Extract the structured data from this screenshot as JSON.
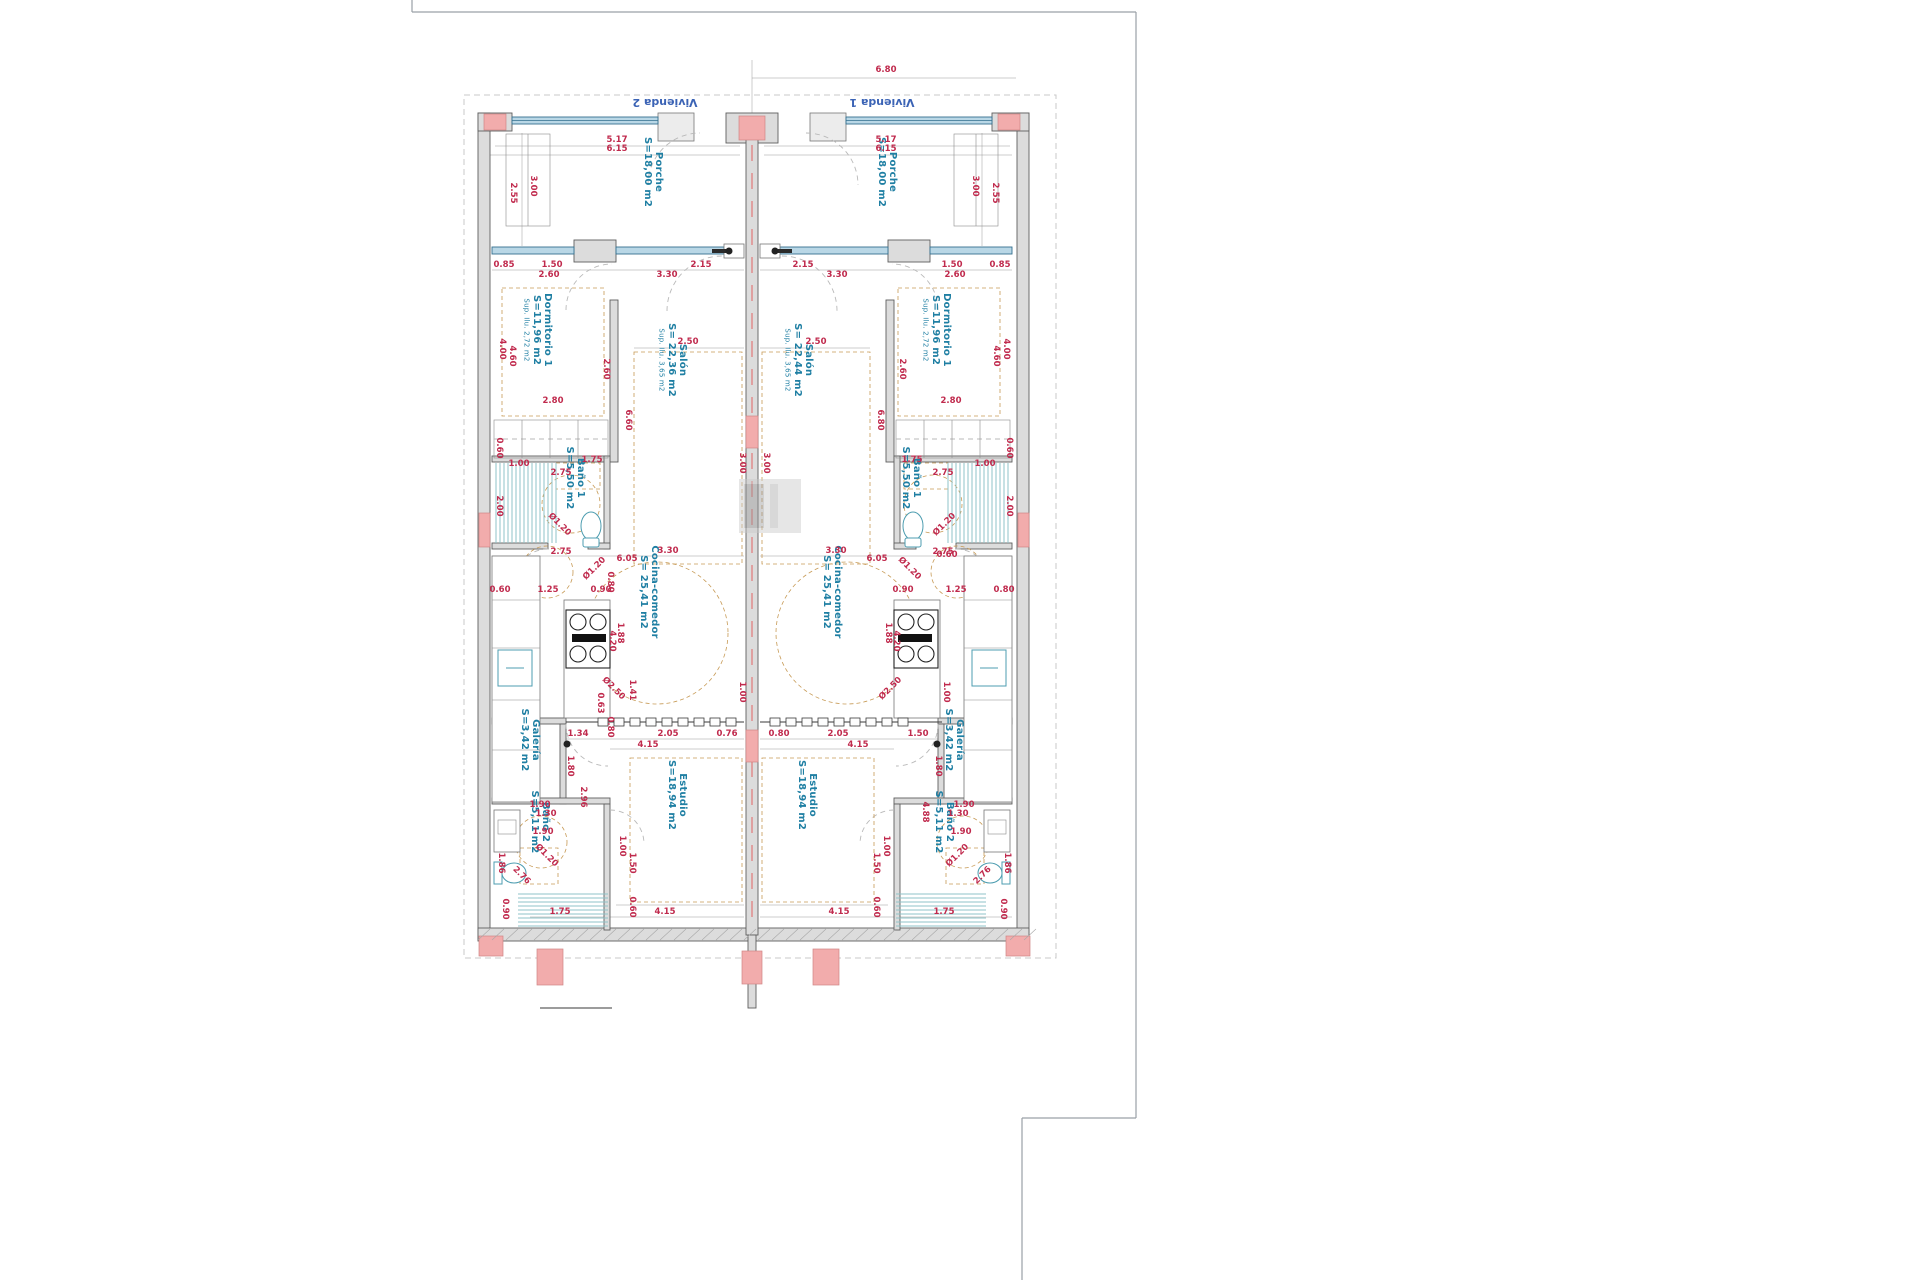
{
  "header": {
    "left_unit": "Vivienda 2",
    "right_unit": "Vivienda 1"
  },
  "rooms": {
    "porche": {
      "name": "Porche",
      "area": "S=18,00 m2"
    },
    "dormitorio1": {
      "name": "Dormitorio 1",
      "area": "S=11,96 m2",
      "sup": "Sup. Ilu. 2,72 m2"
    },
    "salon_left": {
      "name": "Salón",
      "area": "S= 22,36 m2",
      "sup": "Sup. Ilu. 3,65 m2"
    },
    "salon_right": {
      "name": "Salón",
      "area": "S= 22,44 m2",
      "sup": "Sup. Ilu. 3,65 m2"
    },
    "bano1": {
      "name": "Baño 1",
      "area": "S=5,50 m2"
    },
    "cocina": {
      "name": "Cocina-comedor",
      "area": "S= 25,41 m2"
    },
    "galeria": {
      "name": "Galería",
      "area": "S=3,42 m2"
    },
    "estudio": {
      "name": "Estudio",
      "area": "S=18,94 m2"
    },
    "bano2": {
      "name": "Baño 2",
      "area": "S=5,11 m2"
    }
  },
  "room_label_placements": [
    {
      "room": "porche",
      "x": 656,
      "y": 172
    },
    {
      "room": "porche",
      "x": 890,
      "y": 172
    },
    {
      "room": "dormitorio1",
      "x": 545,
      "y": 330
    },
    {
      "room": "dormitorio1",
      "x": 944,
      "y": 330
    },
    {
      "room": "salon_left",
      "x": 680,
      "y": 360
    },
    {
      "room": "salon_right",
      "x": 806,
      "y": 360
    },
    {
      "room": "bano1",
      "x": 578,
      "y": 478
    },
    {
      "room": "bano1",
      "x": 914,
      "y": 478
    },
    {
      "room": "cocina",
      "x": 652,
      "y": 592
    },
    {
      "room": "cocina",
      "x": 835,
      "y": 592
    },
    {
      "room": "galeria",
      "x": 533,
      "y": 740
    },
    {
      "room": "galeria",
      "x": 957,
      "y": 740
    },
    {
      "room": "estudio",
      "x": 680,
      "y": 795
    },
    {
      "room": "estudio",
      "x": 810,
      "y": 795
    },
    {
      "room": "bano2",
      "x": 543,
      "y": 822
    },
    {
      "room": "bano2",
      "x": 947,
      "y": 822
    }
  ],
  "dimensions": [
    {
      "t": "6.80",
      "x": 886,
      "y": 72
    },
    {
      "t": "5.17",
      "x": 617,
      "y": 142
    },
    {
      "t": "6.15",
      "x": 617,
      "y": 151
    },
    {
      "t": "5.17",
      "x": 886,
      "y": 142
    },
    {
      "t": "6.15",
      "x": 886,
      "y": 151
    },
    {
      "t": "3.00",
      "x": 531,
      "y": 186,
      "r": 90
    },
    {
      "t": "2.55",
      "x": 511,
      "y": 193,
      "r": 90
    },
    {
      "t": "3.00",
      "x": 973,
      "y": 186,
      "r": 90
    },
    {
      "t": "2.55",
      "x": 993,
      "y": 193,
      "r": 90
    },
    {
      "t": "0.85",
      "x": 504,
      "y": 267
    },
    {
      "t": "1.50",
      "x": 552,
      "y": 267
    },
    {
      "t": "2.60",
      "x": 549,
      "y": 277
    },
    {
      "t": "3.30",
      "x": 667,
      "y": 277
    },
    {
      "t": "2.15",
      "x": 701,
      "y": 267
    },
    {
      "t": "2.15",
      "x": 803,
      "y": 267
    },
    {
      "t": "3.30",
      "x": 837,
      "y": 277
    },
    {
      "t": "2.60",
      "x": 955,
      "y": 277
    },
    {
      "t": "1.50",
      "x": 952,
      "y": 267
    },
    {
      "t": "0.85",
      "x": 1000,
      "y": 267
    },
    {
      "t": "4.00",
      "x": 500,
      "y": 349,
      "r": 90
    },
    {
      "t": "4.60",
      "x": 510,
      "y": 356,
      "r": 90
    },
    {
      "t": "2.60",
      "x": 604,
      "y": 369,
      "r": 90
    },
    {
      "t": "2.80",
      "x": 553,
      "y": 403
    },
    {
      "t": "0.60",
      "x": 497,
      "y": 448,
      "r": 90
    },
    {
      "t": "4.00",
      "x": 1004,
      "y": 349,
      "r": 90
    },
    {
      "t": "4.60",
      "x": 994,
      "y": 356,
      "r": 90
    },
    {
      "t": "2.60",
      "x": 900,
      "y": 369,
      "r": 90
    },
    {
      "t": "2.80",
      "x": 951,
      "y": 403
    },
    {
      "t": "0.60",
      "x": 1007,
      "y": 448,
      "r": 90
    },
    {
      "t": "2.50",
      "x": 688,
      "y": 344
    },
    {
      "t": "3.00",
      "x": 740,
      "y": 463,
      "r": 90
    },
    {
      "t": "6.60",
      "x": 626,
      "y": 420,
      "r": 90
    },
    {
      "t": "2.50",
      "x": 816,
      "y": 344
    },
    {
      "t": "3.00",
      "x": 764,
      "y": 463,
      "r": 90
    },
    {
      "t": "6.80",
      "x": 878,
      "y": 420,
      "r": 90
    },
    {
      "t": "1.00",
      "x": 519,
      "y": 466
    },
    {
      "t": "2.75",
      "x": 561,
      "y": 475
    },
    {
      "t": "1.75",
      "x": 592,
      "y": 462
    },
    {
      "t": "2.00",
      "x": 497,
      "y": 506,
      "r": 90
    },
    {
      "t": "Ø1.20",
      "x": 558,
      "y": 526,
      "r": 45
    },
    {
      "t": "1.75",
      "x": 912,
      "y": 462
    },
    {
      "t": "2.75",
      "x": 943,
      "y": 475
    },
    {
      "t": "1.00",
      "x": 985,
      "y": 466
    },
    {
      "t": "2.00",
      "x": 1007,
      "y": 506,
      "r": 90
    },
    {
      "t": "Ø1.20",
      "x": 946,
      "y": 526,
      "r": -45
    },
    {
      "t": "2.75",
      "x": 561,
      "y": 554
    },
    {
      "t": "6.05",
      "x": 627,
      "y": 561
    },
    {
      "t": "3.30",
      "x": 668,
      "y": 553
    },
    {
      "t": "0.80",
      "x": 608,
      "y": 582,
      "r": 90
    },
    {
      "t": "Ø1.20",
      "x": 596,
      "y": 570,
      "r": -45
    },
    {
      "t": "0.60",
      "x": 500,
      "y": 592
    },
    {
      "t": "1.25",
      "x": 548,
      "y": 592
    },
    {
      "t": "0.90",
      "x": 601,
      "y": 592
    },
    {
      "t": "1.88",
      "x": 618,
      "y": 633,
      "r": 90
    },
    {
      "t": "4.20",
      "x": 610,
      "y": 641,
      "r": 90
    },
    {
      "t": "Ø2.50",
      "x": 612,
      "y": 690,
      "r": 45
    },
    {
      "t": "1.41",
      "x": 630,
      "y": 690,
      "r": 90
    },
    {
      "t": "0.63",
      "x": 598,
      "y": 703,
      "r": 90
    },
    {
      "t": "1.00",
      "x": 740,
      "y": 692,
      "r": 90
    },
    {
      "t": "0.80",
      "x": 608,
      "y": 727,
      "r": 90
    },
    {
      "t": "2.75",
      "x": 943,
      "y": 554
    },
    {
      "t": "6.05",
      "x": 877,
      "y": 561
    },
    {
      "t": "3.30",
      "x": 836,
      "y": 553
    },
    {
      "t": "0.60",
      "x": 947,
      "y": 557
    },
    {
      "t": "Ø1.20",
      "x": 908,
      "y": 570,
      "r": 45
    },
    {
      "t": "0.90",
      "x": 903,
      "y": 592
    },
    {
      "t": "1.25",
      "x": 956,
      "y": 592
    },
    {
      "t": "0.80",
      "x": 1004,
      "y": 592
    },
    {
      "t": "1.88",
      "x": 886,
      "y": 633,
      "r": 90
    },
    {
      "t": "4.20",
      "x": 894,
      "y": 641,
      "r": 90
    },
    {
      "t": "Ø2.50",
      "x": 892,
      "y": 690,
      "r": -45
    },
    {
      "t": "1.00",
      "x": 944,
      "y": 692,
      "r": 90
    },
    {
      "t": "1.34",
      "x": 578,
      "y": 736
    },
    {
      "t": "2.05",
      "x": 668,
      "y": 736
    },
    {
      "t": "0.76",
      "x": 727,
      "y": 736
    },
    {
      "t": "4.15",
      "x": 648,
      "y": 747
    },
    {
      "t": "0.80",
      "x": 779,
      "y": 736
    },
    {
      "t": "2.05",
      "x": 838,
      "y": 736
    },
    {
      "t": "1.50",
      "x": 918,
      "y": 736
    },
    {
      "t": "4.15",
      "x": 858,
      "y": 747
    },
    {
      "t": "1.80",
      "x": 568,
      "y": 766,
      "r": 90
    },
    {
      "t": "2.96",
      "x": 581,
      "y": 797,
      "r": 90
    },
    {
      "t": "1.90",
      "x": 540,
      "y": 807
    },
    {
      "t": "1.30",
      "x": 546,
      "y": 816
    },
    {
      "t": "1.90",
      "x": 543,
      "y": 834
    },
    {
      "t": "1.86",
      "x": 499,
      "y": 863,
      "r": 90
    },
    {
      "t": "2.76",
      "x": 520,
      "y": 877,
      "r": 45
    },
    {
      "t": "Ø1.20",
      "x": 545,
      "y": 857,
      "r": 45
    },
    {
      "t": "1.00",
      "x": 620,
      "y": 846,
      "r": 90
    },
    {
      "t": "1.50",
      "x": 630,
      "y": 863,
      "r": 90
    },
    {
      "t": "0.90",
      "x": 503,
      "y": 909,
      "r": 90
    },
    {
      "t": "0.60",
      "x": 630,
      "y": 907,
      "r": 90
    },
    {
      "t": "1.75",
      "x": 560,
      "y": 914
    },
    {
      "t": "4.15",
      "x": 665,
      "y": 914
    },
    {
      "t": "1.80",
      "x": 936,
      "y": 766,
      "r": 90
    },
    {
      "t": "4.88",
      "x": 923,
      "y": 812,
      "r": 90
    },
    {
      "t": "1.90",
      "x": 964,
      "y": 807
    },
    {
      "t": "1.30",
      "x": 958,
      "y": 816
    },
    {
      "t": "1.90",
      "x": 961,
      "y": 834
    },
    {
      "t": "1.86",
      "x": 1005,
      "y": 863,
      "r": 90
    },
    {
      "t": "2.76",
      "x": 984,
      "y": 877,
      "r": -45
    },
    {
      "t": "Ø1.20",
      "x": 959,
      "y": 857,
      "r": -45
    },
    {
      "t": "1.00",
      "x": 884,
      "y": 846,
      "r": 90
    },
    {
      "t": "1.50",
      "x": 874,
      "y": 863,
      "r": 90
    },
    {
      "t": "0.90",
      "x": 1001,
      "y": 909,
      "r": 90
    },
    {
      "t": "0.60",
      "x": 874,
      "y": 907,
      "r": 90
    },
    {
      "t": "1.75",
      "x": 944,
      "y": 914
    },
    {
      "t": "4.15",
      "x": 839,
      "y": 914
    }
  ],
  "colors": {
    "dimension_text": "#c02a4d",
    "room_text": "#1f7fa3",
    "unit_text": "#3b63b5",
    "wall_fill": "#dcdcdc",
    "column_pink": "#f2acac",
    "glazing_blue": "#b9d7e6",
    "hatch_teal": "#8fc3c9",
    "furniture_dash_tan": "#c79a55"
  }
}
